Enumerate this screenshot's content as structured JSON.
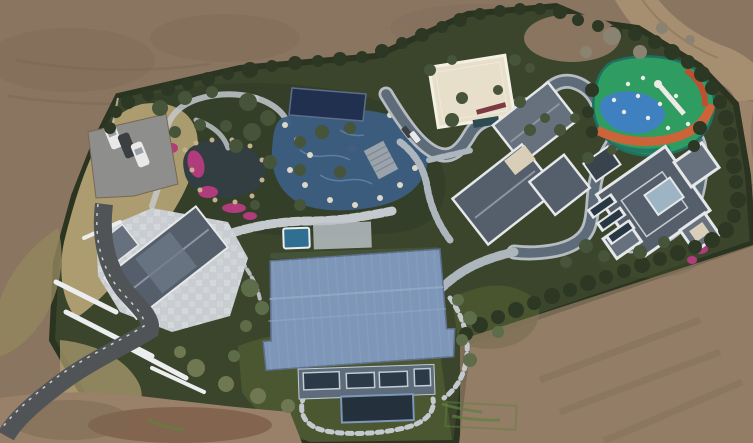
{
  "scene": {
    "type": "aerial-drone-photograph",
    "alt": "Top-down drone photo of a landscaped luxury estate surrounded by bare brown earth: Japanese garden with pond and pink azaleas, blue pool terrace, cream pavilion, colorful playground, three gray-roofed villas, a large blue-roofed barn house, stone plaza, winding gray track and an asphalt driveway",
    "landmarks": {
      "terrain": "bare graded dirt surrounding a green hedged compound, dirt road in top-right corner",
      "parking": "small gray parking pad top-left with three parked cars (white, dark, white)",
      "garden": "dark pond with pink azalea banks, winding light stone footpaths and rockery",
      "pool_terrace": "navy flat cover beside a blue tiled pool area edged with white boulders",
      "cream_pavilion": "flat cream-roofed building upper middle",
      "playground": "organic playground mat with green, blue and orange swirls, white slide and play dots",
      "villa_a": "center villa cluster with dark gray hip roofs and white trim",
      "villa_b": "right villa with square hip roof, central glass skylight and white parapets",
      "barn_house": "large blue standing-seam metal roof building at bottom center with glass facade and dark deck",
      "plaza_house": "bottom-left house with dark gable roof on a light stone mosaic plaza, white retaining walls",
      "driveway": "dark asphalt drive curving to the bottom-left corner",
      "track": "light-edged dark gray path winding among the villas and playground",
      "cars_by_villa": "two small cars parked on the track near the center villa"
    },
    "counts": {
      "parked_cars_top_left": 3,
      "cars_near_villa": 2,
      "villas": 3
    }
  },
  "colors": {
    "bg_dirt": "#8a7560",
    "dirt_dark": "#796752",
    "dirt_light": "#998069",
    "dirt_red": "#7d5c48",
    "dirt_road": "#a68e71",
    "dirt_line": "#8b7355",
    "estate_green": "#3a452c",
    "garden_shade": "#333f28",
    "hedge": "#2a3420",
    "lawn": "#4a5730",
    "lawn_dark": "#3f4c2c",
    "dry_grass": "#b2a173",
    "dry_grass_dark": "#94875f",
    "fence": "#cfc7b4",
    "parking": "#8e8e8c",
    "car_white": "#e9e9e9",
    "car_dark": "#3c3f42",
    "car_glass": "#9aa0a6",
    "pond": "#323e42",
    "azalea": "#b03c7c",
    "stone": "#c4c9ce",
    "paver": "#aeb6bd",
    "rock_white": "#ddd7c8",
    "rock_tan": "#c6b08a",
    "pool_tile": "#3d5e82",
    "pool_wave": "#6d8cab",
    "navy": "#20304e",
    "spa": "#2f6f92",
    "terrace": "#b9bec3",
    "steps": "#9aa3ab",
    "step_line": "#7f8890",
    "red_wall": "#7c3b44",
    "cream": "#e7dfca",
    "cream_edge": "#f4f0e3",
    "teal_strip": "#2e4a52",
    "track": "#5e6c79",
    "track_edge": "#b6bcc2",
    "play_green": "#2f9d62",
    "play_blue": "#3f80c0",
    "play_orange": "#cc6339",
    "play_red": "#bd4f33",
    "play_teal": "#207062",
    "play_white": "#eceae4",
    "roof_dark": "#555f6b",
    "roof_mid": "#67717e",
    "roof_trim": "#e5e7e9",
    "roof_ridge": "#8c95a2",
    "skylight": "#9db4c4",
    "glass_dark": "#283744",
    "garage": "#39434e",
    "cream_sky": "#d9cfb8",
    "glass_tint": "#6e7987",
    "barn_roof": "#7e96b8",
    "barn_seam": "#93a9c6",
    "barn_edge": "#5d6f8c",
    "barn_facade": "#5e6b7a",
    "barn_glass": "#2c3a48",
    "frame": "#c2ccd4",
    "deck": "#24303c",
    "plaza": "#c9cdd1",
    "plaza_light": "#e0e3e6",
    "wall": "#ebedee",
    "asphalt": "#515457",
    "paint": "#5f8040",
    "tree_dark": "#2c3823",
    "tree_mid": "#46543a",
    "tree_light": "#5e6d49",
    "tree_olive": "#707852",
    "tree_bare": "#8b8371"
  }
}
